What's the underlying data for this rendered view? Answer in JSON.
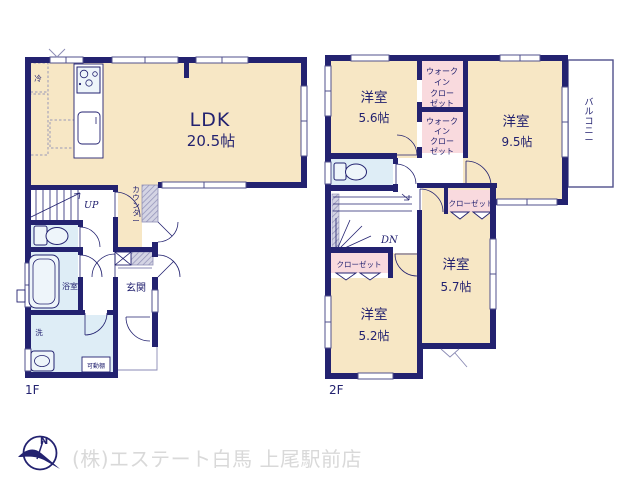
{
  "plan": {
    "f1": {
      "floor_label": "1F",
      "ldk_name": "LDK",
      "ldk_size": "20.5帖",
      "fridge": "冷",
      "counter": "カウンター",
      "entrance": "玄関",
      "bath": "浴室",
      "laundry": "洗",
      "shelf": "可動棚",
      "stairs": "UP"
    },
    "f2": {
      "floor_label": "2F",
      "room_ne_name": "洋室",
      "room_ne_size": "5.6帖",
      "room_e_name": "洋室",
      "room_e_size": "9.5帖",
      "room_se_name": "洋室",
      "room_se_size": "5.7帖",
      "room_s_name": "洋室",
      "room_s_size": "5.2帖",
      "wic_lines": [
        "ウォーク",
        "イン",
        "クロー",
        "ゼット"
      ],
      "closet_a": "クローゼット",
      "closet_b": "クローゼット",
      "balcony": "バルコニー",
      "stairs": "DN"
    }
  },
  "compass": {
    "north": "N"
  },
  "footer": {
    "watermark": "(株)エステート白馬 上尾駅前店"
  },
  "colors": {
    "wall": "#232270",
    "room_beige": "#f7e7c5",
    "closet_pink": "#f9dade",
    "wet_blue": "#deedf6",
    "watermark_gray": "#d9d9d9"
  }
}
